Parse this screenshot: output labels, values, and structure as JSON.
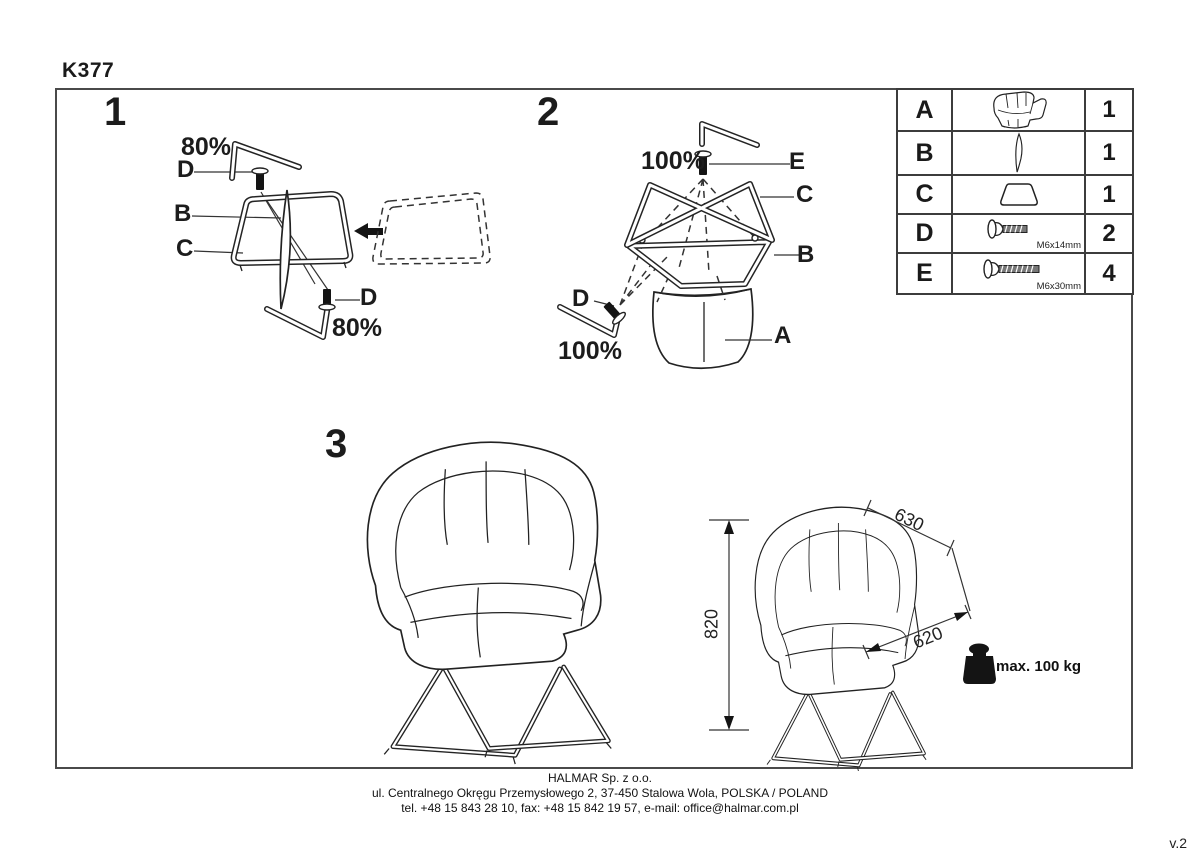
{
  "page": {
    "model": "K377",
    "version": "v.2"
  },
  "footer": {
    "company": "HALMAR Sp. z o.o.",
    "address": "ul. Centralnego Okręgu Przemysłowego 2, 37-450 Stalowa Wola, POLSKA / POLAND",
    "contact": "tel. +48 15 843 28 10, fax: +48 15 842 19 57, e-mail: office@halmar.com.pl"
  },
  "step1": {
    "number": "1",
    "pct_top": "80%",
    "label_d_top": "D",
    "label_b": "B",
    "label_c": "C",
    "label_d_bottom": "D",
    "pct_bottom": "80%"
  },
  "step2": {
    "number": "2",
    "pct_top": "100%",
    "label_e": "E",
    "label_c": "C",
    "label_b": "B",
    "label_d": "D",
    "pct_bottom": "100%",
    "label_a": "A"
  },
  "step3": {
    "number": "3",
    "dim_height": "820",
    "dim_depth": "630",
    "dim_width": "620",
    "max_load": "max. 100 kg"
  },
  "parts_table": {
    "rows": [
      {
        "letter": "A",
        "icon": "chair-shell-icon",
        "qty": "1",
        "size": ""
      },
      {
        "letter": "B",
        "icon": "connector-blade-icon",
        "qty": "1",
        "size": ""
      },
      {
        "letter": "C",
        "icon": "frame-icon",
        "qty": "1",
        "size": ""
      },
      {
        "letter": "D",
        "icon": "bolt-short-icon",
        "qty": "2",
        "size": "M6x14mm"
      },
      {
        "letter": "E",
        "icon": "bolt-long-icon",
        "qty": "4",
        "size": "M6x30mm"
      }
    ]
  }
}
